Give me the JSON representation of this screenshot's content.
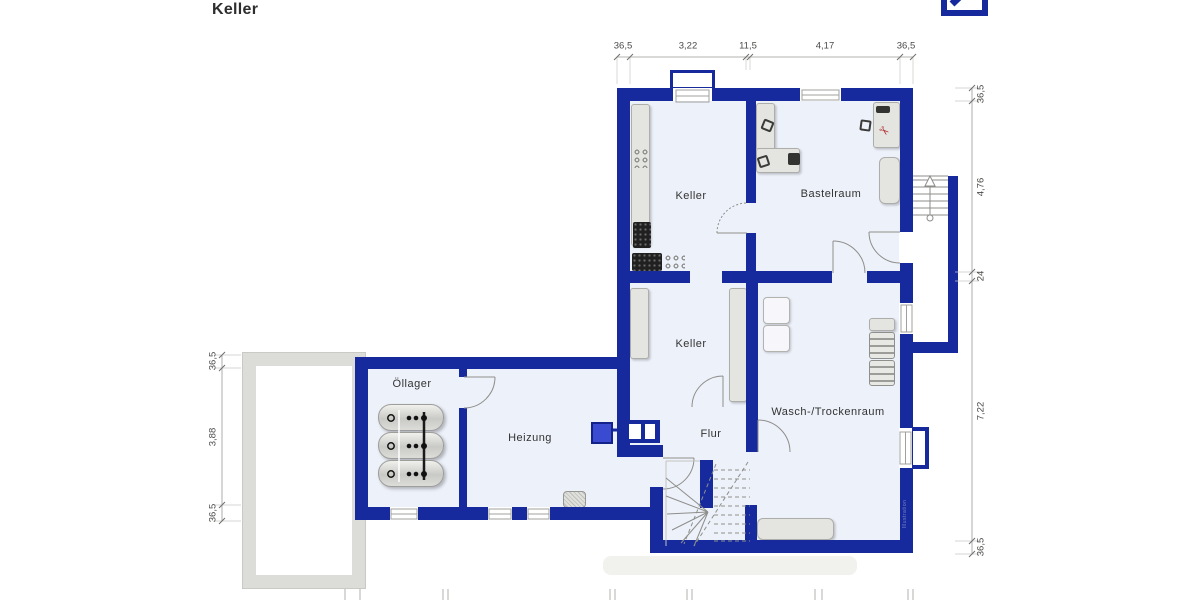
{
  "title": "Keller",
  "logo": {
    "icon": "deutsche-bank-slash-icon"
  },
  "rooms": [
    {
      "id": "keller-top",
      "label": "Keller"
    },
    {
      "id": "bastelraum",
      "label": "Bastelraum"
    },
    {
      "id": "keller-mid",
      "label": "Keller"
    },
    {
      "id": "wasch-trockenraum",
      "label": "Wasch-/Trockenraum"
    },
    {
      "id": "oellager",
      "label": "Öllager"
    },
    {
      "id": "heizung",
      "label": "Heizung"
    },
    {
      "id": "flur",
      "label": "Flur"
    }
  ],
  "dimensions": {
    "top": [
      "36,5",
      "3,22",
      "11,5",
      "4,17",
      "36,5"
    ],
    "right": [
      "36,5",
      "4,76",
      "24",
      "7,22",
      "36,5"
    ],
    "left": [
      "36,5",
      "3,88",
      "36,5"
    ]
  },
  "icons": {
    "red_tool": "✂",
    "stairs_direction": "up-arrow-icon"
  },
  "watermark": "Illustration",
  "colors": {
    "wall": "#162a9e",
    "floor": "#edf1f9",
    "boiler": "#3a4bd2",
    "furniture_fill": "#e4e4e1",
    "furniture_border": "#adadaa",
    "exterior_structure": "#dcdcd9",
    "line": "#8e8e8b",
    "dim_text": "#4a4a48"
  }
}
